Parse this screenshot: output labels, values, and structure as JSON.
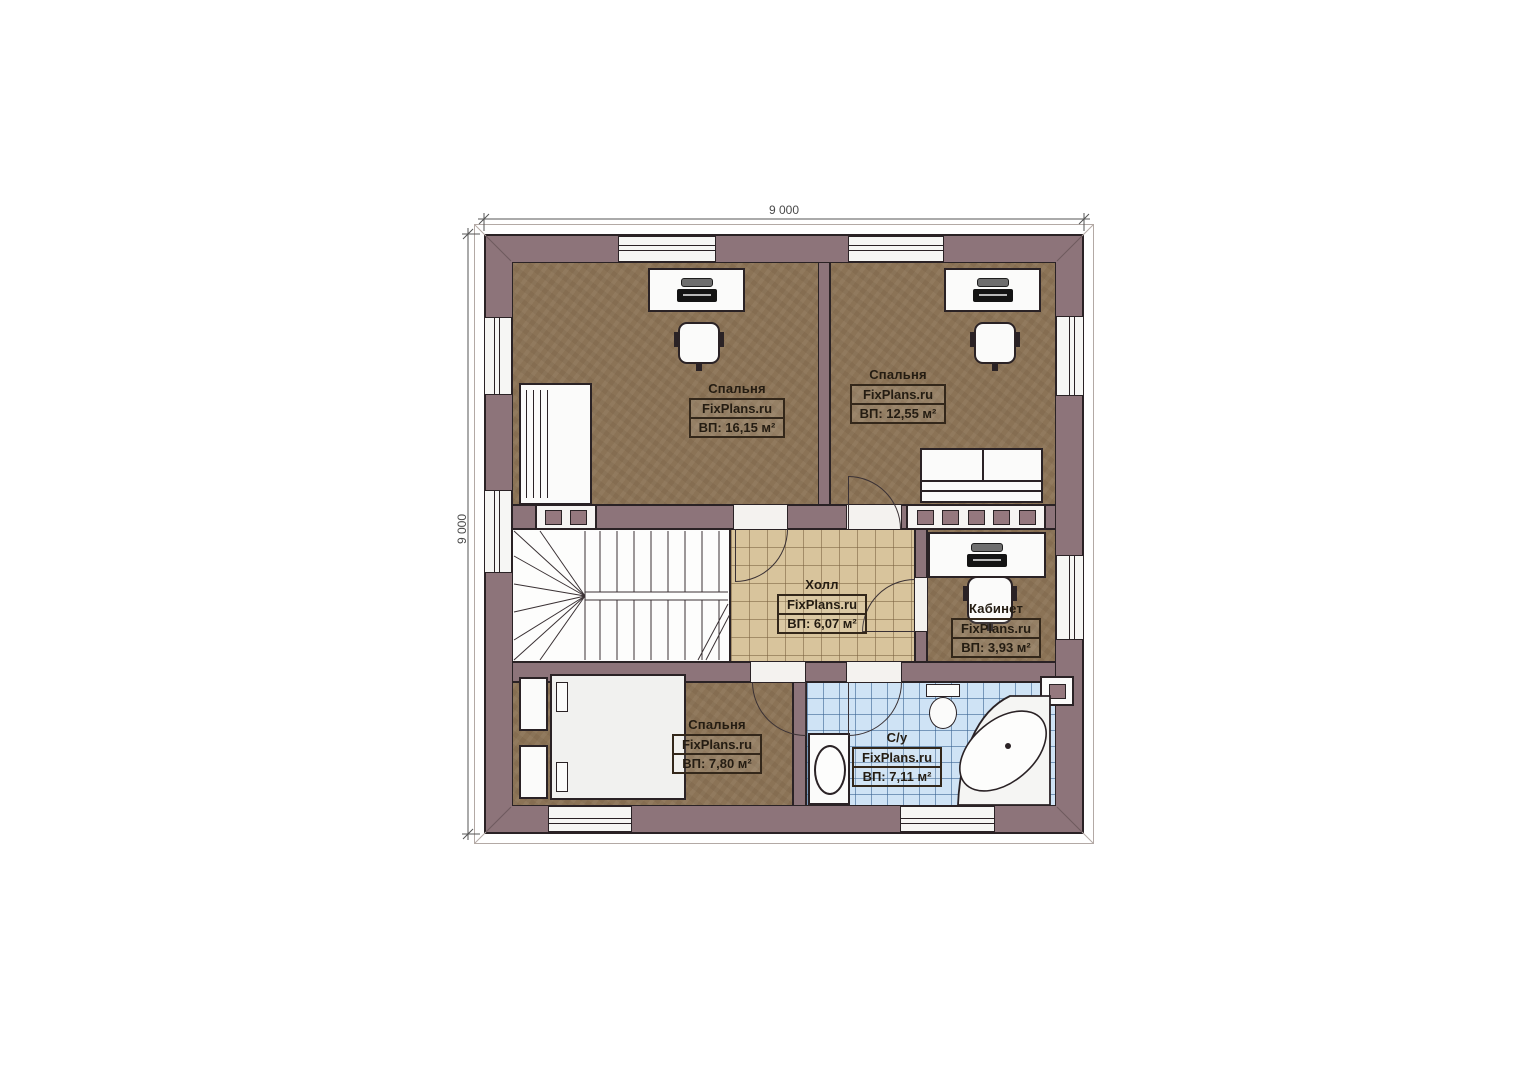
{
  "plan": {
    "dimensions": {
      "width": "9 000",
      "height": "9 000"
    },
    "brand": "FixPlans.ru",
    "rooms": [
      {
        "name": "Спальня",
        "brand": "FixPlans.ru",
        "area": "ВП: 16,15 м²"
      },
      {
        "name": "Спальня",
        "brand": "FixPlans.ru",
        "area": "ВП: 12,55 м²"
      },
      {
        "name": "Холл",
        "brand": "FixPlans.ru",
        "area": "ВП: 6,07 м²"
      },
      {
        "name": "Кабинет",
        "brand": "FixPlans.ru",
        "area": "ВП: 3,93 м²"
      },
      {
        "name": "Спальня",
        "brand": "FixPlans.ru",
        "area": "ВП: 7,80 м²"
      },
      {
        "name": "С/у",
        "brand": "FixPlans.ru",
        "area": "ВП: 7,11 м²"
      }
    ],
    "colors": {
      "wall": "#8d747a",
      "floor_wood": "#8b7356",
      "floor_hall_tile": "#d8c49c",
      "floor_bath_tile": "#cfe3f5",
      "outline": "#2a2225"
    }
  }
}
